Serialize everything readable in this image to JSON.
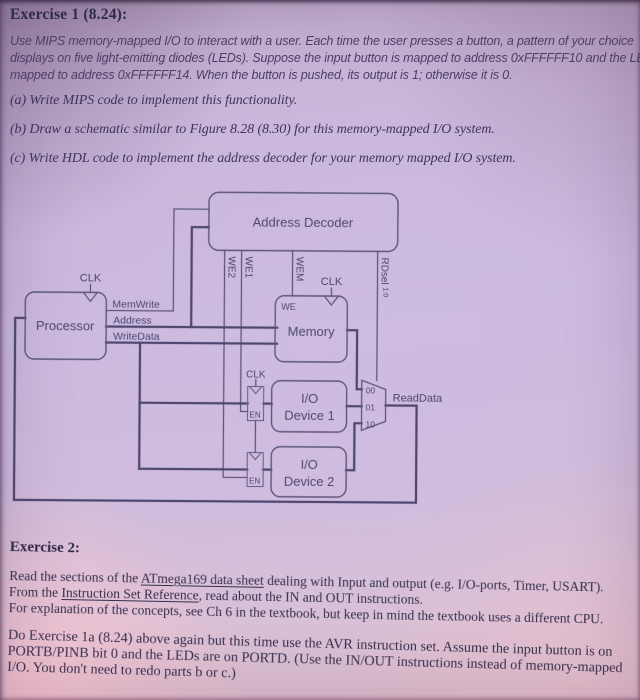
{
  "colors": {
    "paper_lavender": "#ccbade",
    "paper_pink_bottom": "#e3c2cc",
    "ink": "#35304e",
    "diagram_line": "#5d577e"
  },
  "exercise1": {
    "title": "Exercise 1 (8.24):",
    "intro": [
      "Use MIPS memory-mapped I/O to interact with a user. Each time the user presses a button, a pattern of your choice",
      "displays on five light-emitting diodes (LEDs). Suppose the input button is mapped to address 0xFFFFFF10 and the LEDs are",
      "mapped to address 0xFFFFFF14. When the button is pushed, its output is 1; otherwise it is 0."
    ],
    "item_a": "(a) Write MIPS code to implement this functionality.",
    "item_b": "(b) Draw a schematic similar to Figure 8.28 (8.30) for this memory-mapped I/O system.",
    "item_c": "(c) Write HDL code to implement the address decoder for your memory mapped I/O system."
  },
  "diagram": {
    "blocks": {
      "address_decoder": "Address Decoder",
      "processor": "Processor",
      "memory": "Memory",
      "io1_line1": "I/O",
      "io1_line2": "Device 1",
      "io2_line1": "I/O",
      "io2_line2": "Device 2"
    },
    "signals": {
      "clk": "CLK",
      "memwrite": "MemWrite",
      "address": "Address",
      "writedata": "WriteData",
      "we": "WE",
      "en": "EN",
      "we2": "WE2",
      "we1": "WE1",
      "wem": "WEM",
      "rdsel": "RDsel",
      "rdsel_sub": "1:0",
      "readdata": "ReadData",
      "mux00": "00",
      "mux01": "01",
      "mux10": "10"
    }
  },
  "exercise2": {
    "title": "Exercise 2:",
    "p1_l1_pre": "Read the sections of the ",
    "p1_l1_link": "ATmega169 data sheet",
    "p1_l1_post": " dealing with Input and output (e.g. I/O-ports, Timer, USART).",
    "p1_l2_pre": "From the ",
    "p1_l2_link": "Instruction Set Reference",
    "p1_l2_post": ", read about the IN and OUT instructions.",
    "p1_l3": "For explanation of the concepts, see Ch 6 in the textbook, but keep in mind the textbook uses a different CPU.",
    "p2_l1": "Do Exercise 1a (8.24) above again but this time use the AVR instruction set. Assume the input button is on",
    "p2_l2": "PORTB/PINB bit 0 and the LEDs are on PORTD. (Use the IN/OUT instructions instead of memory-mapped",
    "p2_l3": "I/O. You don't need to redo parts b or c.)"
  }
}
